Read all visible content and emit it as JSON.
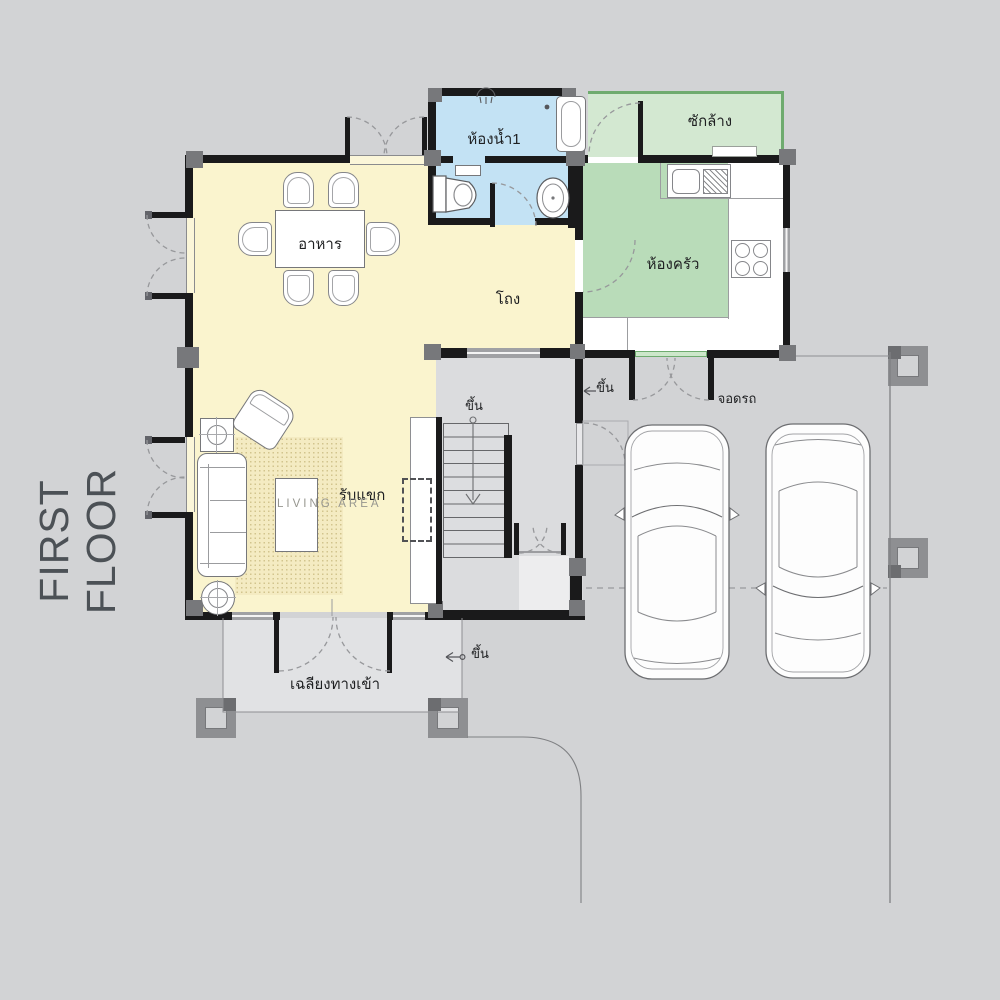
{
  "title": "FIRST FLOOR",
  "rooms": {
    "bathroom1": {
      "label": "ห้องน้ำ1",
      "floor_color": "#c3e2f4"
    },
    "laundry": {
      "label": "ซักล้าง",
      "floor_color": "#d3e8d1"
    },
    "kitchen": {
      "label": "ห้องครัว",
      "floor_color": "#b9dcb9"
    },
    "dining": {
      "label": "อาหาร",
      "floor_color": "#faf4ce"
    },
    "hall": {
      "label": "โถง",
      "floor_color": "#faf4ce"
    },
    "living": {
      "label_th": "รับแขก",
      "label_en": "LIVING AREA",
      "floor_color": "#faf4ce"
    },
    "parking": {
      "label": "จอดรถ"
    },
    "porch": {
      "label": "เฉลียงทางเข้า",
      "floor_color": "#e1e2e4"
    }
  },
  "annotations": {
    "stairs_up": "ขึ้น",
    "parking_step_up": "ขึ้น",
    "porch_step_up": "ขึ้น"
  },
  "palette": {
    "background": "#d2d3d5",
    "wall": "#1a1a1b",
    "column": "#77787b",
    "window": "#a4a5a8",
    "door_arc": "#97989b",
    "green_edge": "#6fab6f",
    "stair_hall": "#dbdcde",
    "title_color": "#4c5156"
  }
}
